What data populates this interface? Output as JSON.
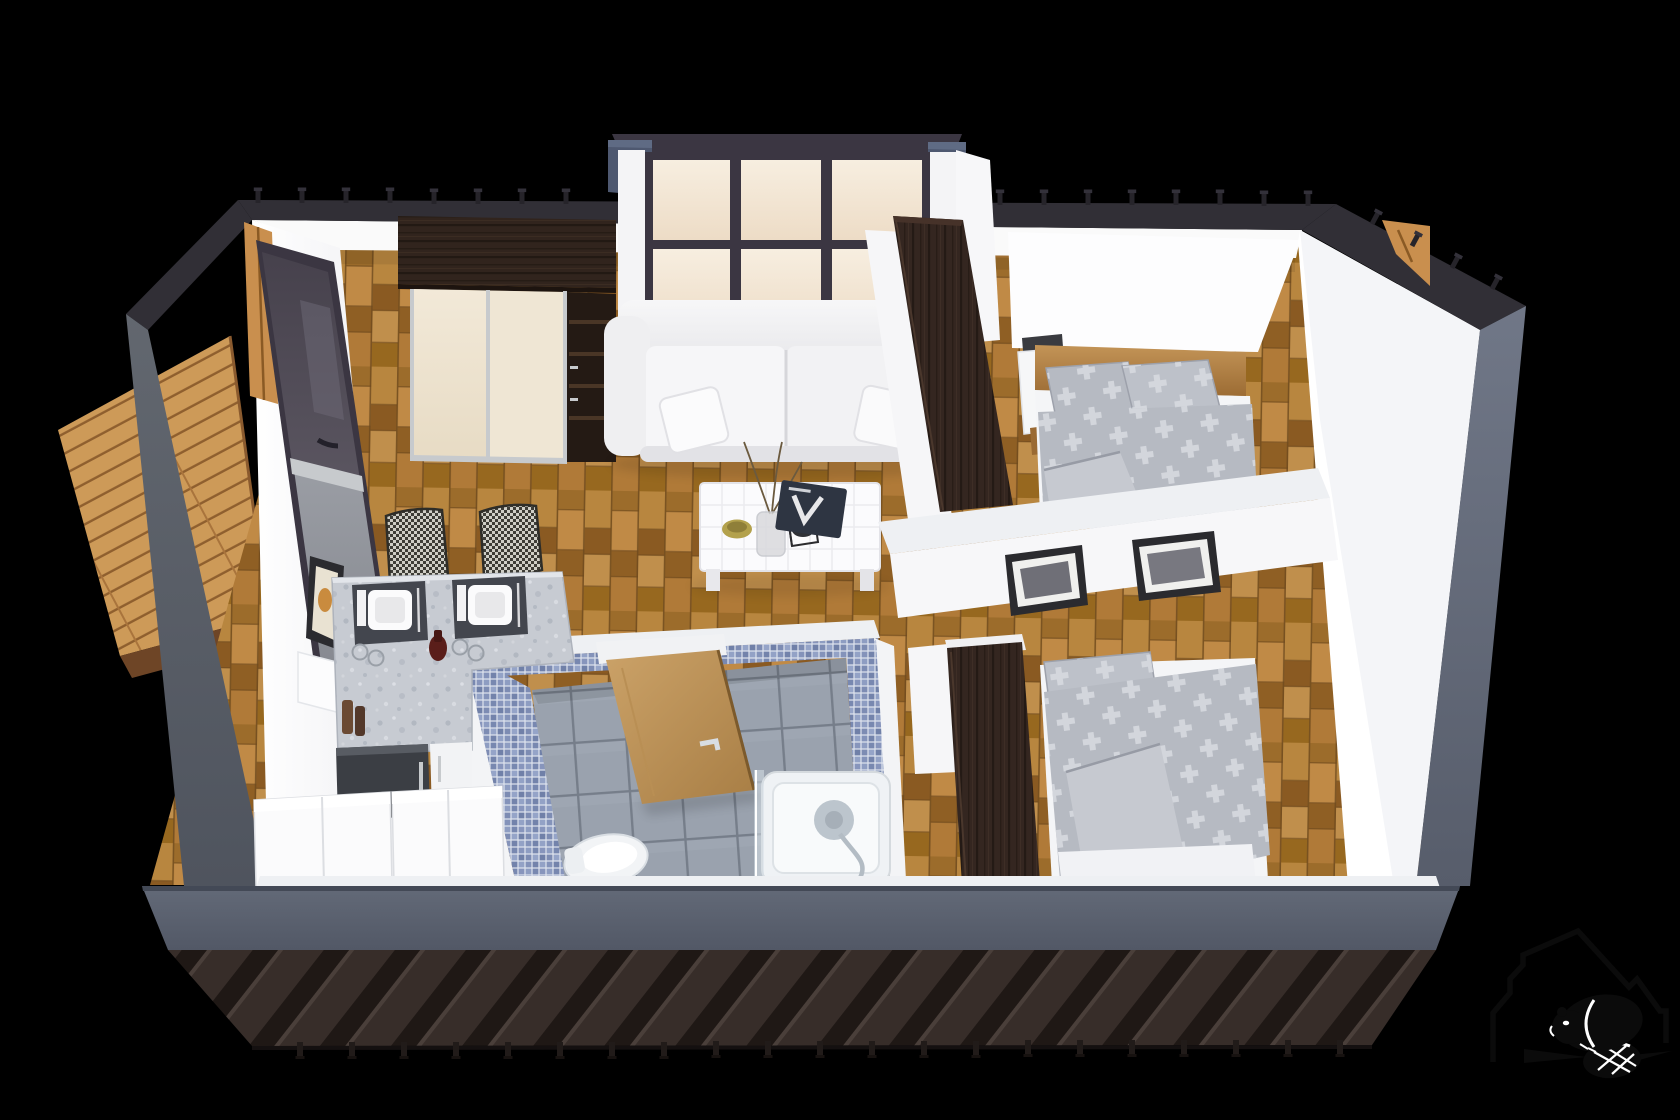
{
  "meta": {
    "title": "Isometric 3D cutaway floor plan rendering of a two-bedroom modular home",
    "canvas": {
      "width": 1680,
      "height": 1120
    },
    "background": "#000000"
  },
  "palette": {
    "bg": "#000000",
    "wallTopDark": "#312f36",
    "wallOuterLeft": "#5a5f6b",
    "wallOuterRight": "#6a7080",
    "frontBand": "#5c6371",
    "skirtBase": "#372d29",
    "skirtRib": "#1f1815",
    "deckPlank": "#cd9a58",
    "deckEdge": "#6e4526",
    "wallWhite": "#fafafa",
    "wallCut": "#eef0f3",
    "parquetMid": "#a8772e",
    "glassCream": "#f4e8d8",
    "frameDark": "#3b3642",
    "capBlue": "#4e5870",
    "wengeDark": "#342620",
    "doorCream": "#efe6d4",
    "trimSilver": "#c7cacd",
    "sofaWhite": "#f3f3f5",
    "tableWhite": "#fbfbfd",
    "mosaicBlue": "#8493ba",
    "tileGray": "#99a1ad",
    "bathDoorWood": "#c49a5f",
    "tubWhite": "#eff2f5",
    "chrome": "#bcc5cd",
    "counterGray": "#c7cbd2",
    "placemat": "#43464e",
    "applianceDark": "#3b3e44",
    "cabinetWhite": "#fbfbfc",
    "beddingGray": "#b6bac2",
    "beddingLight": "#d5d8de",
    "mattressWhite": "#f4f5f7",
    "bedWood": "#b5854a",
    "nightstandWhite": "#f6f7f8",
    "shelfDark": "#3a3b40",
    "pictureFrame": "#2b2b2f",
    "timber": "#c98f4e",
    "wine": "#5a1e1a",
    "logoBlack": "#0b0b0b",
    "pegDark": "#26242a"
  },
  "scene": {
    "view": "isometric cutaway from above, dark charcoal exterior shell on black background",
    "exterior": {
      "front_band": "slate gray fascia strip across full width",
      "skirt": "dark brown diagonal plank siding below fascia",
      "deck": "golden wood terrace outside the left sliding door",
      "pegs_top_count": 20,
      "pegs_bottom_count": 21
    },
    "rooms": [
      {
        "name": "living-room",
        "position": "top-center",
        "features": [
          "bay window wall with cream glass and dark mullions",
          "white two-seat sofa",
          "white grid-top coffee table with vase, bowl, lantern and book",
          "sliding-door wardrobe in dark wenge with cream doors and open shelves",
          "sliding glass door to deck",
          "parquet floor"
        ]
      },
      {
        "name": "kitchen-dining",
        "position": "bottom-left",
        "features": [
          "L-shaped speckled gray counter",
          "two place settings with plates, cutlery and glasses",
          "wine bottle and pepper mills",
          "two houndstooth dining chairs",
          "dark built-in appliance",
          "white base cabinets",
          "small picture on wall",
          "white upper cabinet"
        ]
      },
      {
        "name": "bathroom",
        "position": "bottom-center",
        "features": [
          "blue mosaic walls",
          "gray tile floor",
          "wooden door standing ajar",
          "white toilet",
          "bathtub with chrome shower fitting and glass screen"
        ]
      },
      {
        "name": "bedroom-1",
        "position": "top-right",
        "features": [
          "double bed with wooden headboard",
          "gray cross-pattern pillows and duvet",
          "white nightstand with wood drawer",
          "dark wall shelf",
          "tall dark wenge wardrobe"
        ]
      },
      {
        "name": "bedroom-2",
        "position": "bottom-right",
        "features": [
          "double bed with gray cross-pattern duvet",
          "white mattress edge",
          "tall dark wenge wardrobe",
          "partition wall with two black framed pictures"
        ]
      }
    ],
    "logo": {
      "description": "black emblem: house / mountain outline with a beaver and crosshatched tail",
      "position": "bottom-right"
    }
  }
}
